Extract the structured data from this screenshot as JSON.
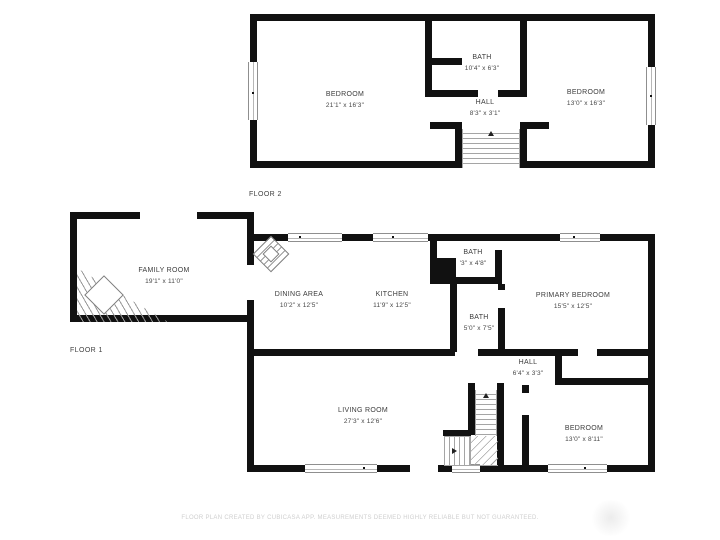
{
  "floor2": {
    "label": "FLOOR 2",
    "rooms": [
      {
        "name": "BEDROOM",
        "dims": "21'1\" x 16'3\""
      },
      {
        "name": "BATH",
        "dims": "10'4\" x 6'3\""
      },
      {
        "name": "HALL",
        "dims": "8'3\" x 3'1\""
      },
      {
        "name": "BEDROOM",
        "dims": "13'0\" x 16'3\""
      }
    ]
  },
  "floor1": {
    "label": "FLOOR 1",
    "rooms": [
      {
        "name": "FAMILY ROOM",
        "dims": "19'1\" x 11'0\""
      },
      {
        "name": "DINING AREA",
        "dims": "10'2\" x 12'5\""
      },
      {
        "name": "KITCHEN",
        "dims": "11'9\" x 12'5\""
      },
      {
        "name": "BATH",
        "dims": "'3\" x 4'8\""
      },
      {
        "name": "BATH",
        "dims": "5'0\" x 7'5\""
      },
      {
        "name": "PRIMARY BEDROOM",
        "dims": "15'5\" x 12'5\""
      },
      {
        "name": "HALL",
        "dims": "6'4\" x 3'3\""
      },
      {
        "name": "LIVING ROOM",
        "dims": "27'3\" x 12'6\""
      },
      {
        "name": "BEDROOM",
        "dims": "13'0\" x 8'11\""
      }
    ]
  },
  "footer": {
    "text": "FLOOR PLAN CREATED BY CUBICASA APP. MEASUREMENTS DEEMED HIGHLY RELIABLE BUT NOT GUARANTEED."
  },
  "colors": {
    "wall": "#111111",
    "room_text": "#3c3c3c",
    "footer_text": "#cfcfcf",
    "window_frame": "#8f8f8f"
  }
}
